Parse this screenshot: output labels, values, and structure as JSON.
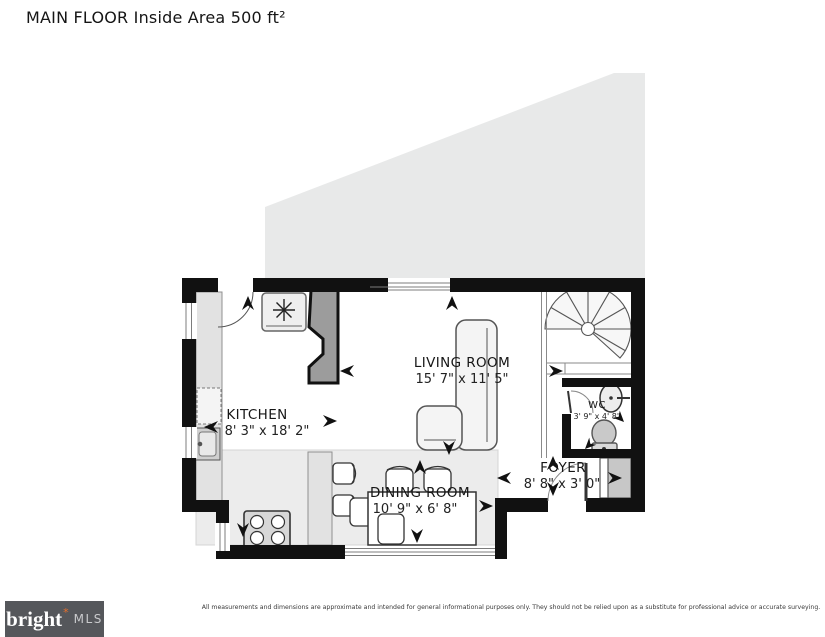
{
  "title": "MAIN FLOOR Inside Area 500 ft²",
  "rooms": {
    "kitchen": {
      "name": "KITCHEN",
      "dims": "8' 3\" x 18' 2\""
    },
    "living": {
      "name": "LIVING ROOM",
      "dims": "15' 7\" x 11' 5\""
    },
    "dining": {
      "name": "DINING ROOM",
      "dims": "10' 9\" x 6' 8\""
    },
    "foyer": {
      "name": "FOYER",
      "dims": "8' 8\" x 3' 0\""
    },
    "wc": {
      "name": "WC",
      "dims": "3' 9\" x 4' 8\""
    }
  },
  "footer": {
    "disclaimer": "All measurements and dimensions are approximate and intended for general informational purposes only. They should not be relied upon as a substitute for professional advice or accurate surveying.",
    "logo": {
      "brand": "bright",
      "star": "*",
      "suffix": "MLS"
    }
  },
  "colors": {
    "wall": "#111111",
    "floor_shade": "#ececec",
    "counter": "#e2e2e2",
    "upper_area_shade": "#e8e9e9",
    "chimney": "#9c9c9c",
    "logo_bg": "#55575b",
    "logo_star": "#e8702a"
  },
  "icons": {
    "fireplace_symbol": "asterisk-fan",
    "arrows": "dimension-arrowheads"
  }
}
